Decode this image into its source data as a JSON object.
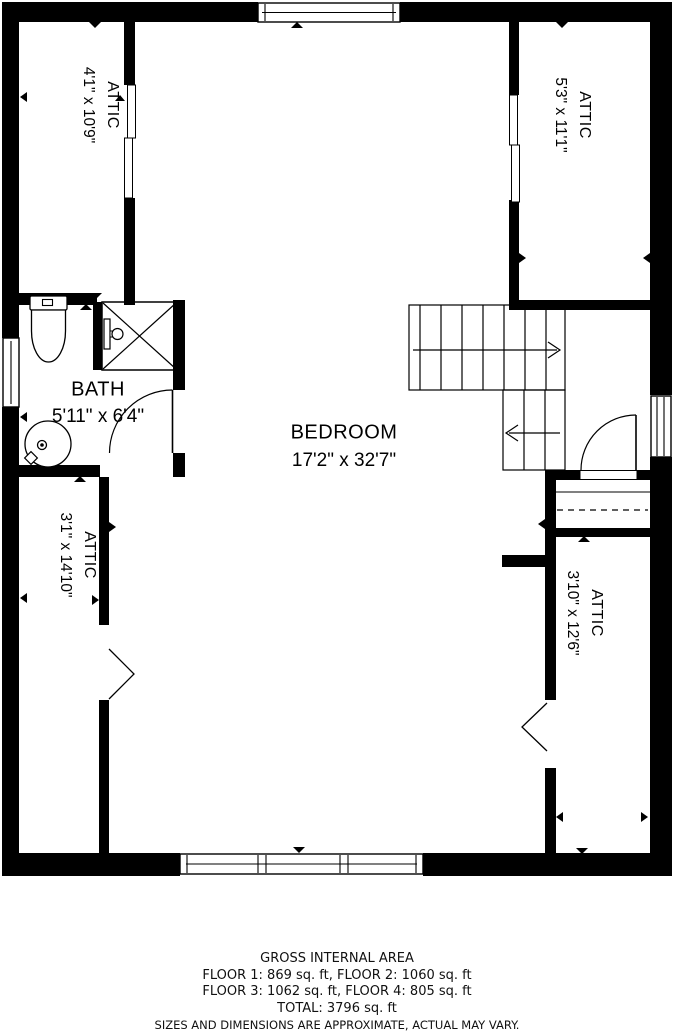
{
  "plan": {
    "rooms": {
      "attic_top_left": {
        "name": "ATTIC",
        "dims": "4'1\" x 10'9\""
      },
      "attic_top_right": {
        "name": "ATTIC",
        "dims": "5'3\" x 11'1\""
      },
      "bath": {
        "name": "BATH",
        "dims": "5'11\" x 6'4\""
      },
      "bedroom": {
        "name": "BEDROOM",
        "dims": "17'2\" x 32'7\""
      },
      "attic_bottom_left": {
        "name": "ATTIC",
        "dims": "3'1\" x 14'10\""
      },
      "attic_bottom_right": {
        "name": "ATTIC",
        "dims": "3'10\" x 12'6\""
      }
    },
    "colors": {
      "wall": "#000000",
      "background": "#ffffff",
      "text": "#000000"
    }
  },
  "footer": {
    "title": "GROSS INTERNAL AREA",
    "line1": "FLOOR 1: 869 sq. ft, FLOOR 2: 1060 sq. ft",
    "line2": "FLOOR 3: 1062 sq. ft, FLOOR 4: 805 sq. ft",
    "total": "TOTAL: 3796 sq. ft",
    "disclaimer": "SIZES AND DIMENSIONS ARE APPROXIMATE, ACTUAL MAY VARY."
  }
}
